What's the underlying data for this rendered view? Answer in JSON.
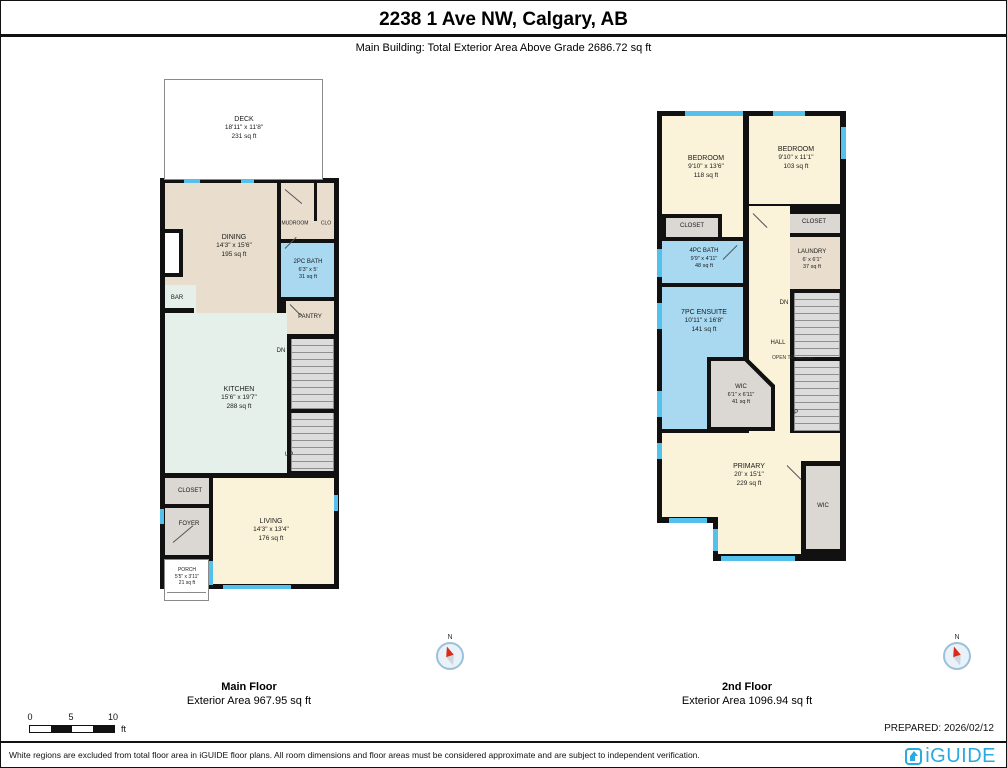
{
  "page": {
    "title": "2238 1 Ave NW, Calgary, AB",
    "subtitle": "Main Building: Total Exterior Area Above Grade 2686.72 sq ft",
    "prepared": "PREPARED: 2026/02/12",
    "disclaimer": "White regions are excluded from total floor area in iGUIDE floor plans. All room dimensions and floor areas must be considered approximate and are subject to independent verification.",
    "brand": "iGUIDE",
    "brand_color": "#29ABE2",
    "compass_label": "N"
  },
  "scale_bar": {
    "tick0": "0",
    "tick1": "5",
    "tick2": "10",
    "unit": "ft"
  },
  "floors": [
    {
      "name": "Main Floor",
      "area_label": "Exterior Area 967.95 sq ft",
      "rooms": {
        "deck": {
          "name": "DECK",
          "dims": "18'11\" x 11'8\"",
          "area": "231 sq ft"
        },
        "dining": {
          "name": "DINING",
          "dims": "14'3\" x 15'6\"",
          "area": "195 sq ft"
        },
        "mudroom": {
          "name": "MUDROOM"
        },
        "clo": {
          "name": "CLO"
        },
        "bath": {
          "name": "2PC BATH",
          "dims": "6'3\" x 5'",
          "area": "31 sq ft"
        },
        "fp": {
          "name": "F/P"
        },
        "bar": {
          "name": "BAR"
        },
        "pantry": {
          "name": "PANTRY"
        },
        "kitchen": {
          "name": "KITCHEN",
          "dims": "15'6\" x 19'7\"",
          "area": "288 sq ft"
        },
        "dn": {
          "name": "DN"
        },
        "up": {
          "name": "UP"
        },
        "closet": {
          "name": "CLOSET"
        },
        "foyer": {
          "name": "FOYER"
        },
        "living": {
          "name": "LIVING",
          "dims": "14'3\" x 13'4\"",
          "area": "176 sq ft"
        },
        "porch": {
          "name": "PORCH",
          "dims": "5'5\" x 3'11\"",
          "area": "21 sq ft"
        }
      }
    },
    {
      "name": "2nd Floor",
      "area_label": "Exterior Area 1096.94 sq ft",
      "rooms": {
        "bedroom1": {
          "name": "BEDROOM",
          "dims": "9'10\" x 13'6\"",
          "area": "118 sq ft"
        },
        "bedroom2": {
          "name": "BEDROOM",
          "dims": "9'10\" x 11'1\"",
          "area": "103 sq ft"
        },
        "closet1": {
          "name": "CLOSET"
        },
        "closet2": {
          "name": "CLOSET"
        },
        "bath": {
          "name": "4PC BATH",
          "dims": "9'9\" x 4'11\"",
          "area": "48 sq ft"
        },
        "laundry": {
          "name": "LAUNDRY",
          "dims": "6' x 6'1\"",
          "area": "37 sq ft"
        },
        "ensuite": {
          "name": "7PC ENSUITE",
          "dims": "10'11\" x 16'8\"",
          "area": "141 sq ft"
        },
        "dn": {
          "name": "DN"
        },
        "hall": {
          "name": "HALL"
        },
        "open_below": {
          "name": "OPEN TO BELOW"
        },
        "wic1": {
          "name": "WIC",
          "dims": "6'1\" x 6'11\"",
          "area": "41 sq ft"
        },
        "up": {
          "name": "UP"
        },
        "primary": {
          "name": "PRIMARY",
          "dims": "20' x 15'1\"",
          "area": "229 sq ft"
        },
        "wic2": {
          "name": "WIC"
        }
      }
    }
  ]
}
